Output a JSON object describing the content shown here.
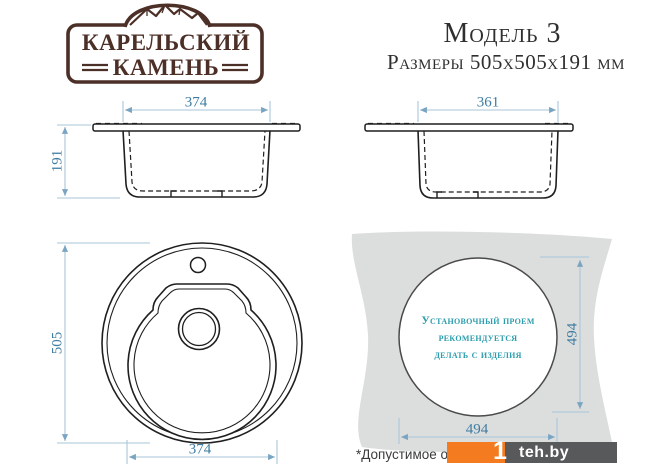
{
  "brand": {
    "line1": "КАРЕЛЬСКИЙ",
    "line2": "КАМЕНЬ"
  },
  "header": {
    "model": "Модель 3",
    "sizes": "Размеры 505x505x191 мм"
  },
  "side_view_left": {
    "width_label": "374",
    "height_label": "191"
  },
  "side_view_right": {
    "width_label": "361"
  },
  "top_view": {
    "diameter_label": "505",
    "bowl_width_label": "374"
  },
  "cutout_view": {
    "note_line1": "Установочный проем",
    "note_line2": "рекомендуется",
    "note_line3": "делать с изделия",
    "height_label": "494",
    "width_label": "494"
  },
  "footnote": "*Допустимое от",
  "watermark": {
    "one": "1",
    "site": "teh.by"
  },
  "colors": {
    "logo_brown": "#4c2f27",
    "dimension_line": "#a9c6da",
    "dimension_arrow": "#7aa5c2",
    "dimension_text": "#3e7ca1",
    "drawing_line": "#1f1f1f",
    "note_teal": "#2b9dad",
    "countertop_gray": "#dcdddd",
    "watermark_orange": "#f47b20",
    "watermark_dark": "#58595b"
  }
}
